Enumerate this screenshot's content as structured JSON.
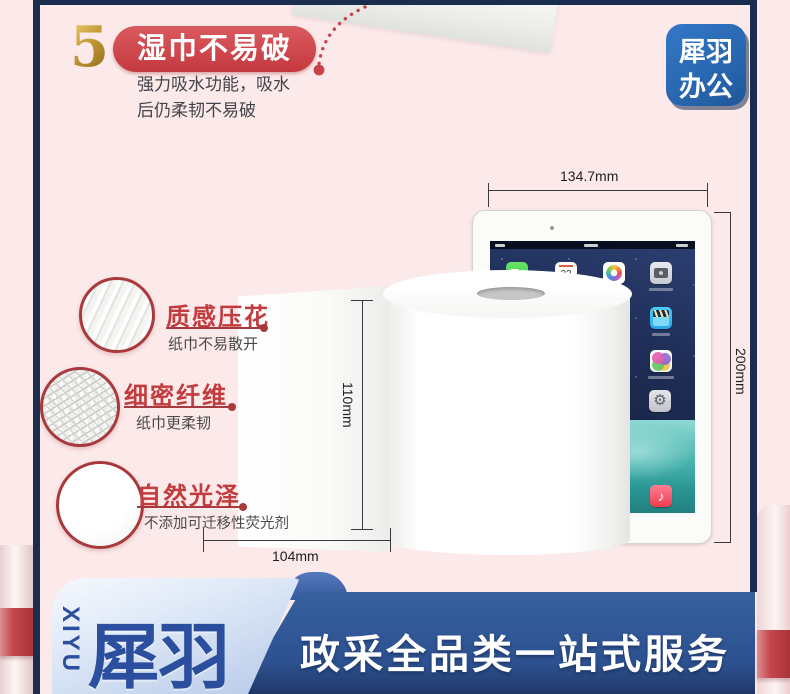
{
  "colors": {
    "background_pink": "#fce9e9",
    "frame_navy": "#1b2d4f",
    "accent_red": "#c94449",
    "brand_blue": "#2b4f9e",
    "banner_blue": "#2e5494",
    "logo_blue": "#2a6ab4",
    "gold": "#a87d22"
  },
  "header": {
    "step_number": "5",
    "badge_label": "湿巾不易破",
    "desc_line1": "强力吸水功能，吸水",
    "desc_line2": "后仍柔韧不易破"
  },
  "brand_badge": {
    "line1": "犀羽",
    "line2": "办公"
  },
  "features": [
    {
      "title": "质感压花",
      "desc": "纸巾不易散开"
    },
    {
      "title": "细密纤维",
      "desc": "纸巾更柔韧"
    },
    {
      "title": "自然光泽",
      "desc": "不添加可迁移性荧光剂"
    }
  ],
  "measurements": {
    "tablet_width": "134.7mm",
    "tablet_height": "200mm",
    "roll_height": "110mm",
    "roll_width": "104mm"
  },
  "tablet": {
    "calendar_day": "22",
    "settings_glyph": "⚙",
    "music_glyph": "♪",
    "icons": [
      "facetime-icon",
      "calendar-icon",
      "photos-icon",
      "camera-icon",
      "videos-icon",
      "game-center-icon",
      "settings-icon",
      "music-icon"
    ]
  },
  "footer": {
    "vertical_brand": "XIYU",
    "brand": "犀羽",
    "slogan": "政采全品类一站式服务"
  }
}
